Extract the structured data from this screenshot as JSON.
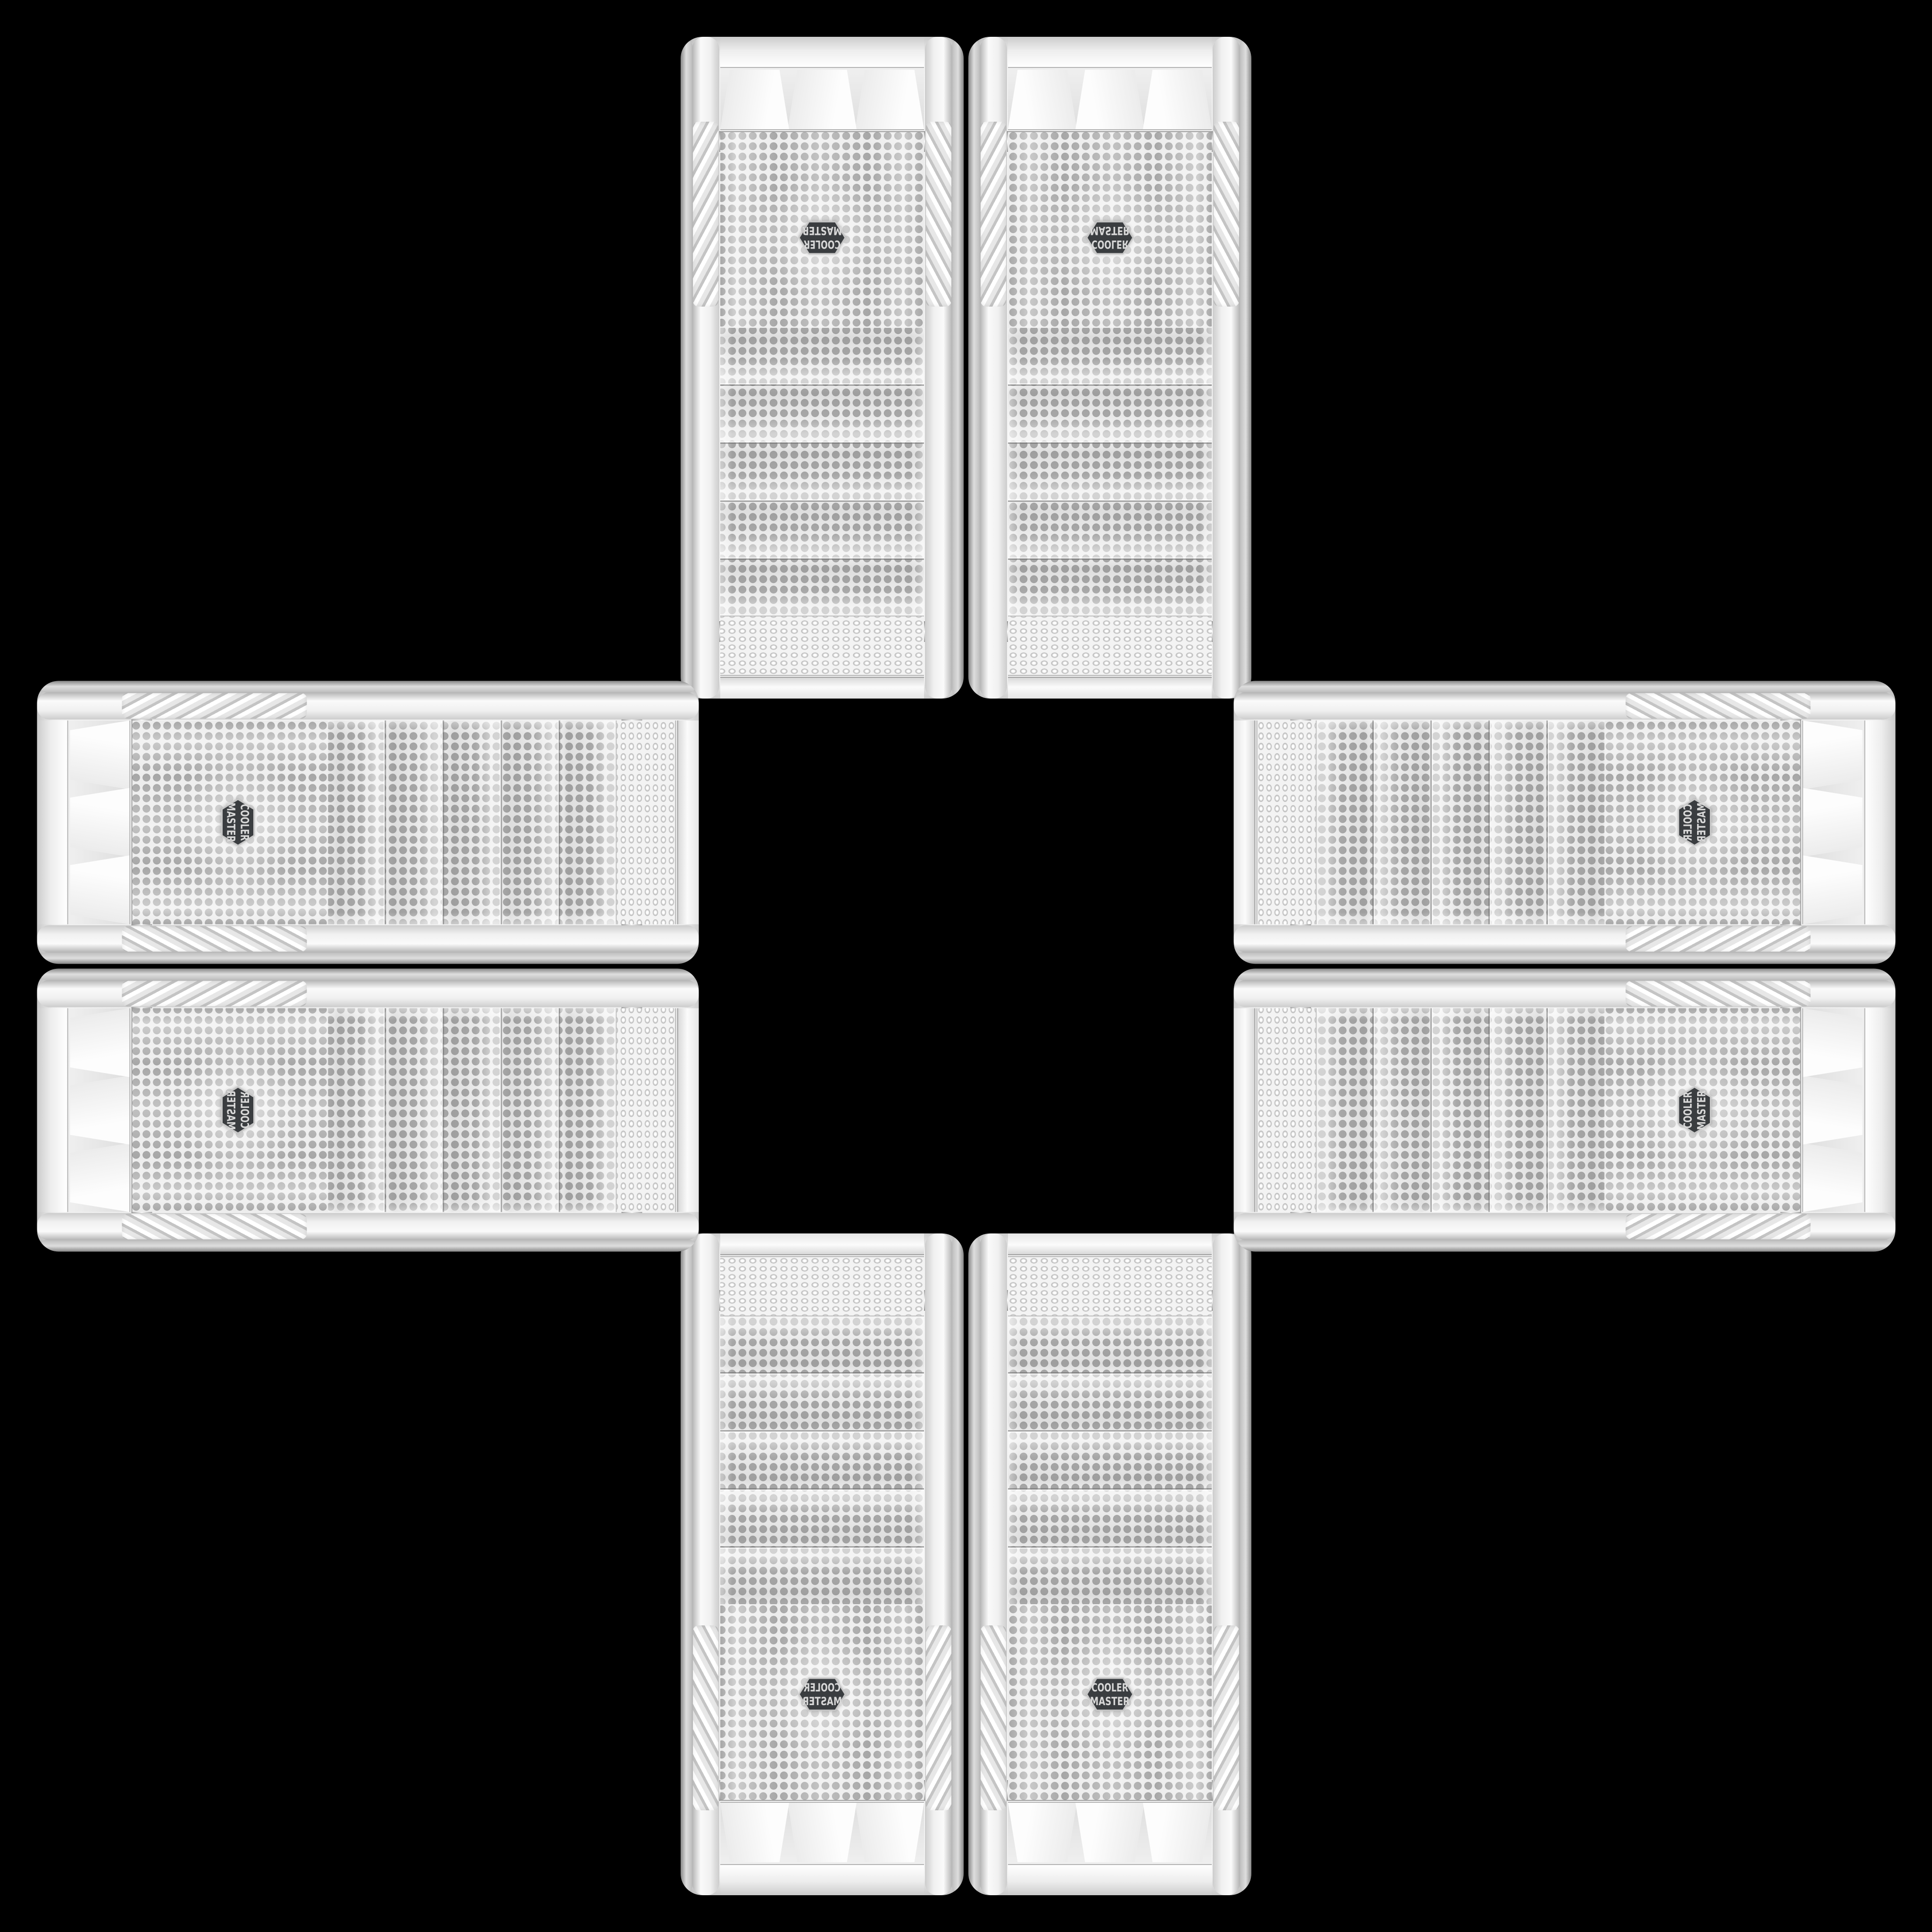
{
  "scene": {
    "background_color": "#000000",
    "description": "Eight identical white Cooler Master PC tower front panels arranged edge-to-edge in a plus / cross pattern on a black background. Each arm of the cross is a mirrored pair of panels; the drive-bay ends all face the center of the cross and the logo mesh ends face outward."
  },
  "badge": {
    "line1": "COOLER",
    "line2": "MASTER",
    "shape": "hexagon",
    "background": "#3a3d40",
    "border": "#c6c6c6",
    "text_color": "#d8d8d8"
  },
  "palette": {
    "background": "#000000",
    "case_body": "#f4f4f4",
    "case_edge": "#bfbfbf",
    "mesh_web": "#e9e9e9",
    "mesh_dot": "#a7a7a7",
    "chrome_trim": "#b0b0b0",
    "grip_shadow": "#c4c4c4",
    "badge_text": "#d8d8d8"
  },
  "counts": {
    "total_cases": 8,
    "cases_per_arm": 2,
    "drive_bays_per_case": 5
  },
  "cases": [
    {
      "id": "top-left",
      "arm": "top",
      "orientation": "vertical",
      "logo_appearance": "upside-down"
    },
    {
      "id": "top-right",
      "arm": "top",
      "orientation": "vertical",
      "logo_appearance": "upside-down mirrored"
    },
    {
      "id": "bottom-left",
      "arm": "bottom",
      "orientation": "vertical",
      "logo_appearance": "mirrored"
    },
    {
      "id": "bottom-right",
      "arm": "bottom",
      "orientation": "vertical",
      "logo_appearance": "upright readable"
    },
    {
      "id": "left-top",
      "arm": "left",
      "orientation": "horizontal",
      "logo_appearance": "rotated 90deg"
    },
    {
      "id": "left-bottom",
      "arm": "left",
      "orientation": "horizontal",
      "logo_appearance": "rotated 90deg mirrored"
    },
    {
      "id": "right-top",
      "arm": "right",
      "orientation": "horizontal",
      "logo_appearance": "rotated 90deg mirrored"
    },
    {
      "id": "right-bottom",
      "arm": "right",
      "orientation": "horizontal",
      "logo_appearance": "rotated 90deg"
    }
  ]
}
